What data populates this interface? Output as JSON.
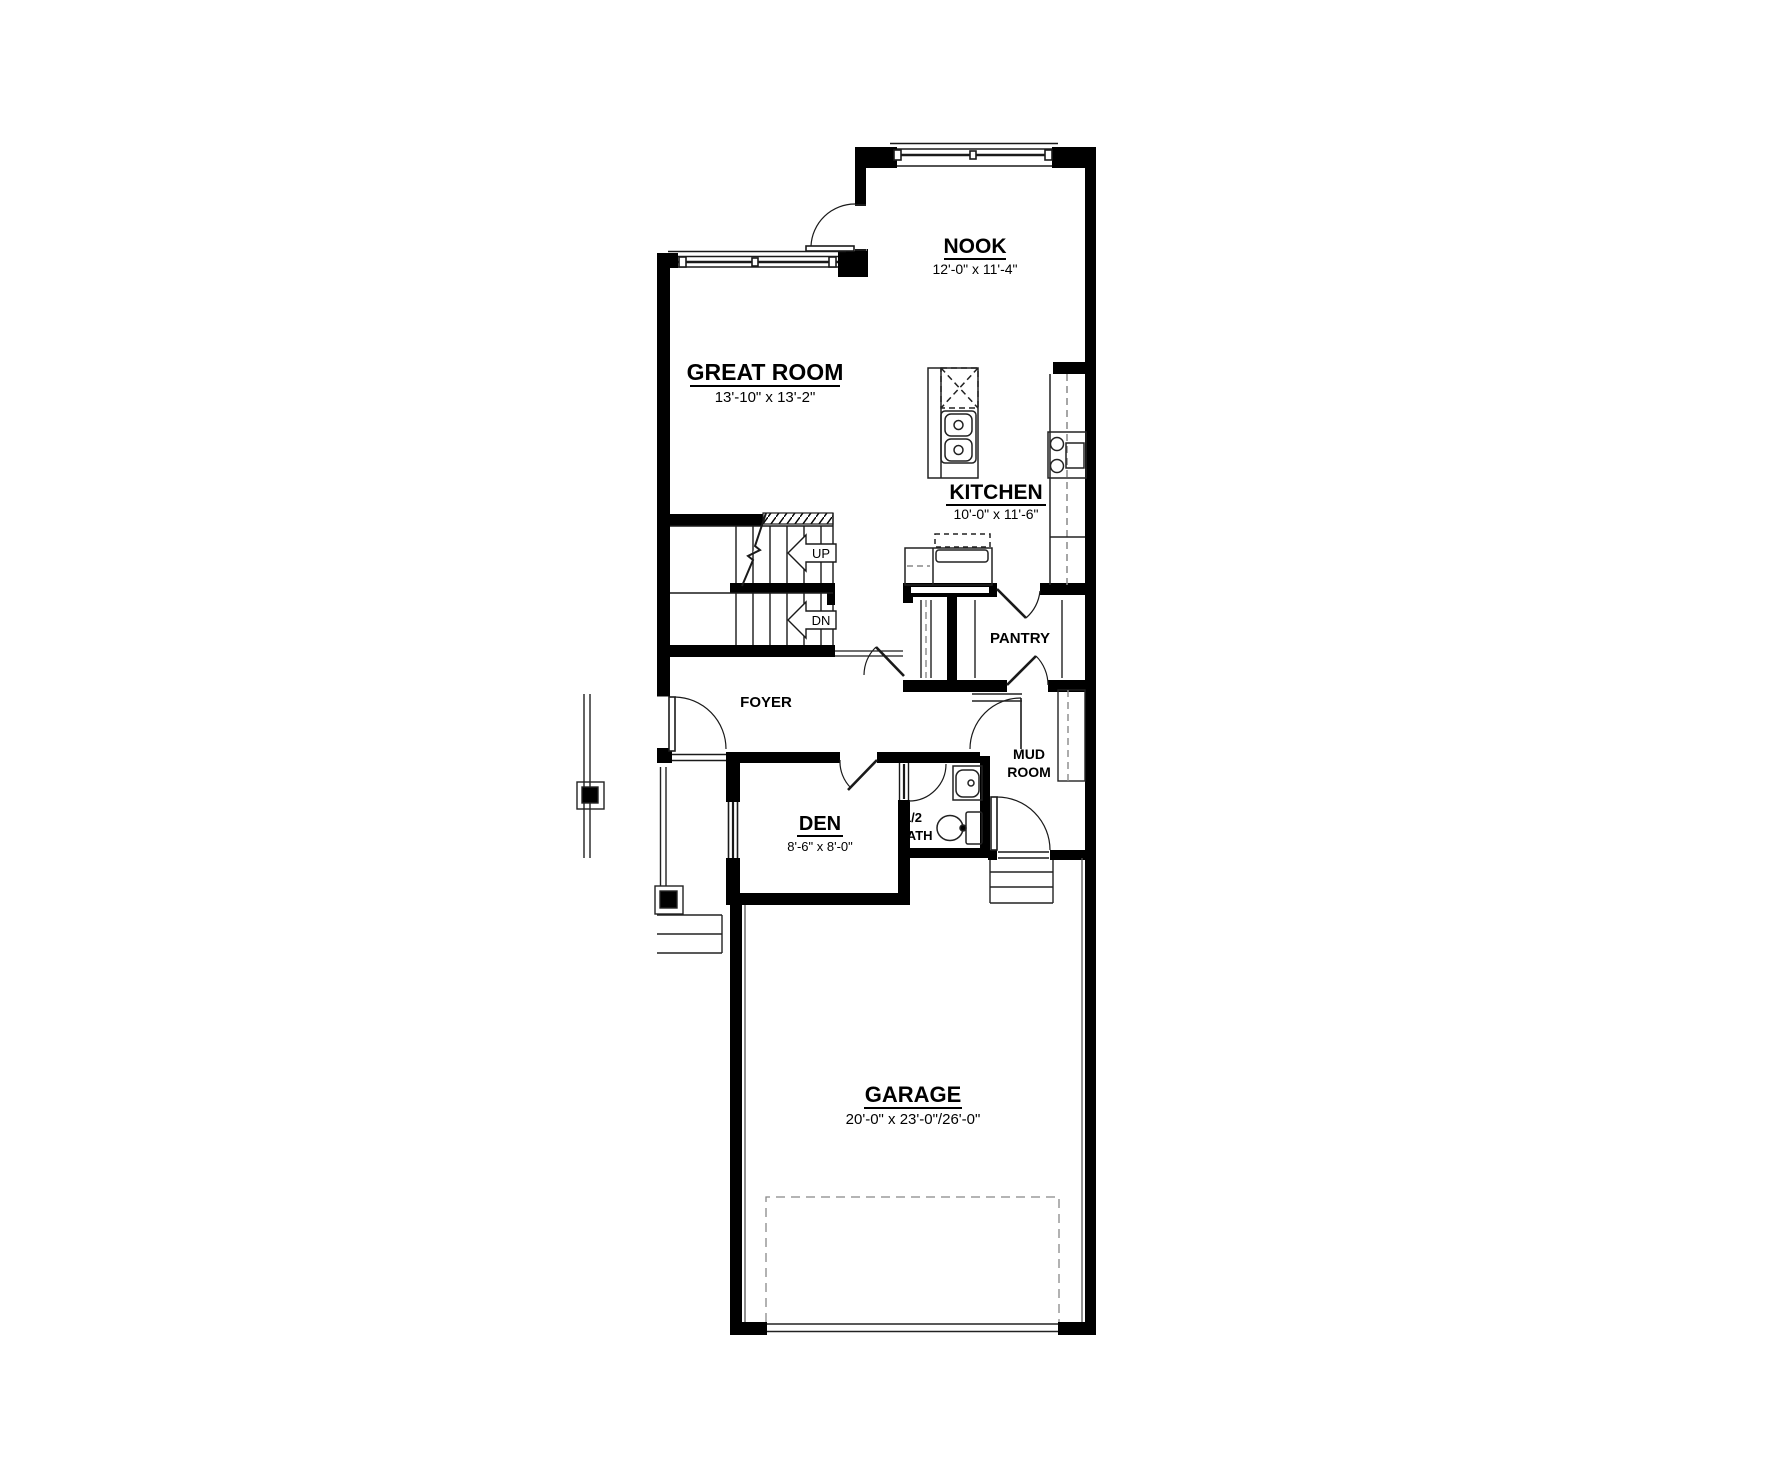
{
  "plan": {
    "title": "Main floor plan",
    "rooms": {
      "nook": {
        "name": "NOOK",
        "dims": "12'-0\" x 11'-4\""
      },
      "great_room": {
        "name": "GREAT ROOM",
        "dims": "13'-10\" x 13'-2\""
      },
      "kitchen": {
        "name": "KITCHEN",
        "dims": "10'-0\" x 11'-6\""
      },
      "pantry": {
        "name": "PANTRY"
      },
      "foyer": {
        "name": "FOYER"
      },
      "mud_room": {
        "line1": "MUD",
        "line2": "ROOM"
      },
      "den": {
        "name": "DEN",
        "dims": "8'-6\" x 8'-0\""
      },
      "half_bath": {
        "line1": "1/2",
        "line2": "BATH"
      },
      "garage": {
        "name": "GARAGE",
        "dims": "20'-0\" x 23'-0\"/26'-0\""
      }
    },
    "stairs": {
      "up_label": "UP",
      "down_label": "DN"
    },
    "colors": {
      "wall": "#000000",
      "line": "#1a1a1a",
      "dashed": "#888888",
      "background": "#ffffff"
    }
  }
}
